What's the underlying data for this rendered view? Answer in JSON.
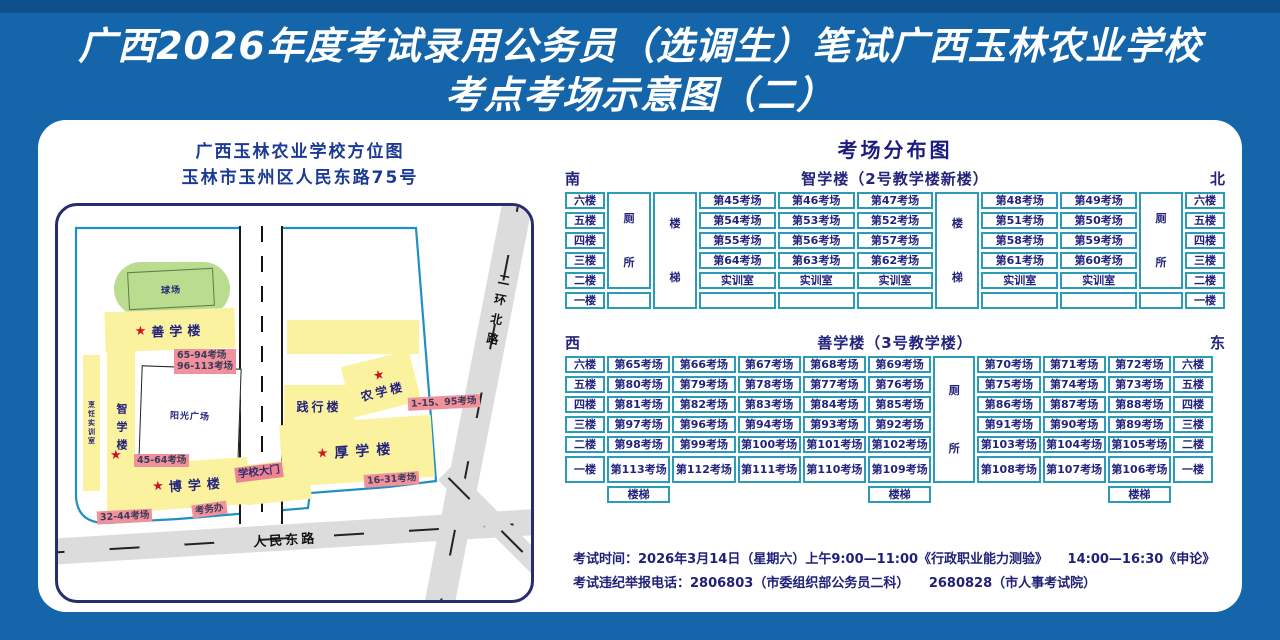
{
  "colors": {
    "blue_bg": "#1565ab",
    "blue_dark": "#0f4f8c",
    "navy": "#23237d",
    "heading_navy": "#1a3a96",
    "teal": "#2b9cb8",
    "campus": "#2090c2",
    "yellow": "#fbf2a0",
    "green": "#b9dc8e",
    "pink": "#f0919b",
    "gate_pink": "#ee8390",
    "road": "#dcdcdc",
    "star": "#d11222",
    "white": "#ffffff"
  },
  "title": {
    "line1": "广西2026年度考试录用公务员（选调生）笔试广西玉林农业学校",
    "line2": "考点考场示意图（二）"
  },
  "map": {
    "heading_line1": "广西玉林农业学校方位图",
    "heading_line2": "玉林市玉州区人民东路75号",
    "playground": "球场",
    "sunshine_square": "阳光广场",
    "star_icon": "★",
    "buildings": {
      "shanxue": "善学楼",
      "zhixue": "智学楼",
      "pengren": "烹饪实训室",
      "boxue": "博学楼",
      "jianxing": "践行楼",
      "nongxue": "农学楼",
      "houxue": "厚学楼"
    },
    "labels": {
      "shanxue_rooms_line1": "65-94考场",
      "shanxue_rooms_line2": "96-113考场",
      "zhixue_rooms": "45-64考场",
      "boxue_rooms": "32-44考场",
      "nongxue_rooms": "1-15、95考场",
      "houxue_rooms": "16-31考场",
      "gate": "学校大门",
      "exam_office": "考务办"
    },
    "roads": {
      "renmin": "人民东路",
      "erhuan": "二环北路"
    }
  },
  "distribution": {
    "heading": "考场分布图",
    "table1": {
      "dir_left": "南",
      "dir_right": "北",
      "caption": "智学楼（2号教学楼新楼）",
      "floors": [
        "六楼",
        "五楼",
        "四楼",
        "三楼",
        "二楼",
        "一楼"
      ],
      "toilet": "厕所",
      "stairs": "楼梯",
      "left_rows": [
        [
          "第45考场",
          "第46考场",
          "第47考场"
        ],
        [
          "第54考场",
          "第53考场",
          "第52考场"
        ],
        [
          "第55考场",
          "第56考场",
          "第57考场"
        ],
        [
          "第64考场",
          "第63考场",
          "第62考场"
        ],
        [
          "实训室",
          "实训室",
          "实训室"
        ],
        [
          "",
          "",
          ""
        ]
      ],
      "right_rows": [
        [
          "第48考场",
          "第49考场"
        ],
        [
          "第51考场",
          "第50考场"
        ],
        [
          "第58考场",
          "第59考场"
        ],
        [
          "第61考场",
          "第60考场"
        ],
        [
          "实训室",
          "实训室"
        ],
        [
          "",
          ""
        ]
      ]
    },
    "table2": {
      "dir_left": "西",
      "dir_right": "东",
      "caption": "善学楼（3号教学楼）",
      "floors": [
        "六楼",
        "五楼",
        "四楼",
        "三楼",
        "二楼",
        "一楼"
      ],
      "toilet": "厕所",
      "stairs": "楼梯",
      "left_rows": [
        [
          "第65考场",
          "第66考场",
          "第67考场",
          "第68考场",
          "第69考场"
        ],
        [
          "第80考场",
          "第79考场",
          "第78考场",
          "第77考场",
          "第76考场"
        ],
        [
          "第81考场",
          "第82考场",
          "第83考场",
          "第84考场",
          "第85考场"
        ],
        [
          "第97考场",
          "第96考场",
          "第94考场",
          "第93考场",
          "第92考场"
        ],
        [
          "第98考场",
          "第99考场",
          "第100考场",
          "第101考场",
          "第102考场"
        ],
        [
          "第113考场",
          "第112考场",
          "第111考场",
          "第110考场",
          "第109考场"
        ]
      ],
      "right_rows": [
        [
          "第70考场",
          "第71考场",
          "第72考场"
        ],
        [
          "第75考场",
          "第74考场",
          "第73考场"
        ],
        [
          "第86考场",
          "第87考场",
          "第88考场"
        ],
        [
          "第91考场",
          "第90考场",
          "第89考场"
        ],
        [
          "第103考场",
          "第104考场",
          "第105考场"
        ],
        [
          "第108考场",
          "第107考场",
          "第106考场"
        ]
      ]
    }
  },
  "footer": {
    "line1": "考试时间：2026年3月14日（星期六）上午9:00—11:00《行政职业能力测验》　　14:00—16:30《申论》",
    "line2": "考试违纪举报电话：2806803（市委组织部公务员二科）　　2680828（市人事考试院）"
  }
}
